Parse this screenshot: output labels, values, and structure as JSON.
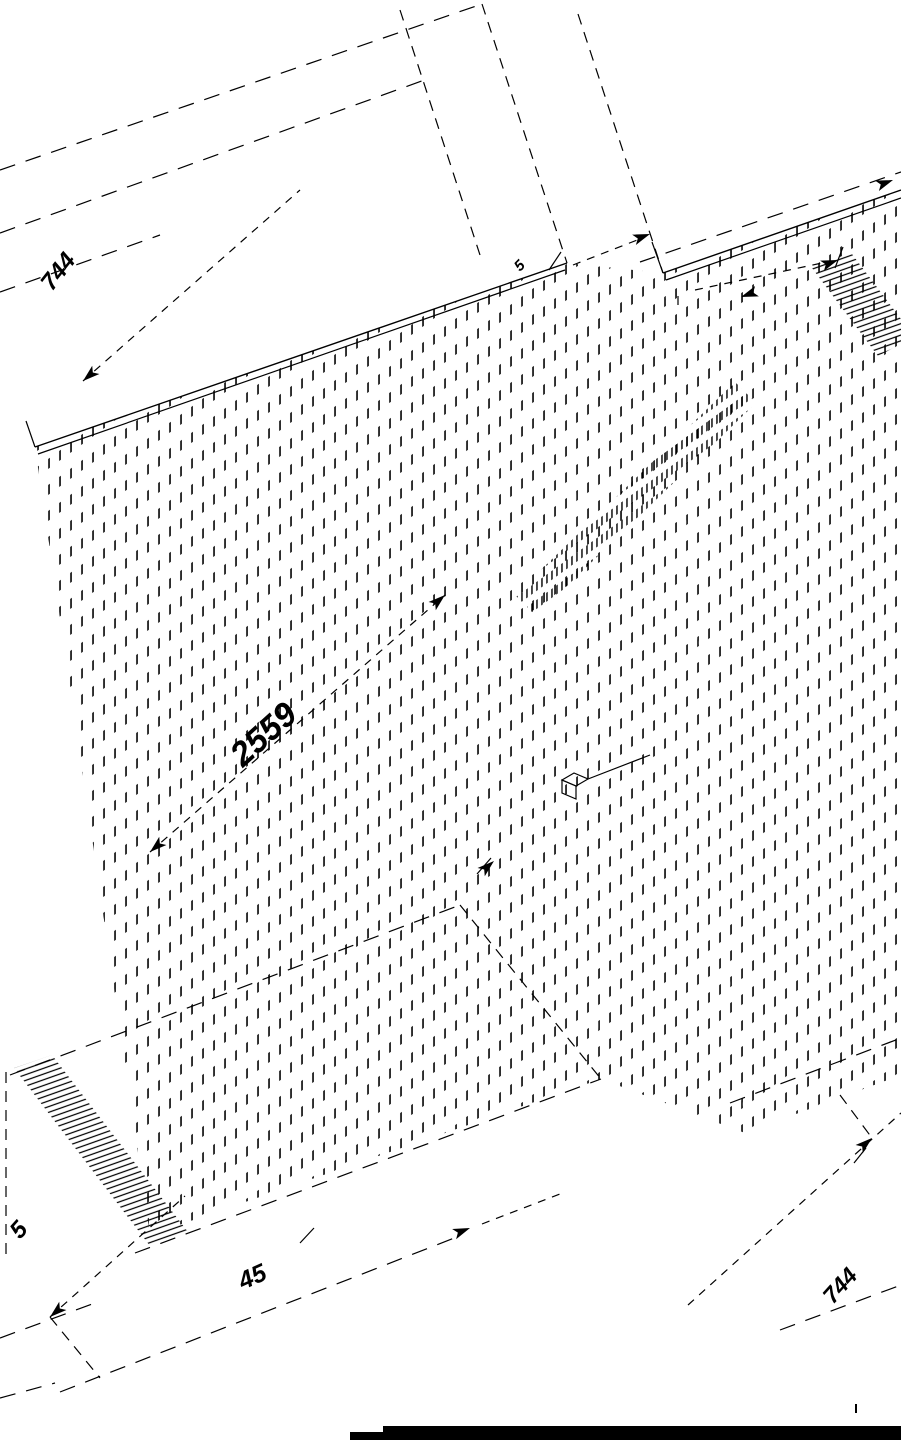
{
  "drawing": {
    "type": "isometric-panel-technical-drawing",
    "background_color": "#ffffff",
    "line_color": "#000000",
    "panels": [
      {
        "name": "left-panel",
        "hatched": true
      },
      {
        "name": "right-panel",
        "hatched": true
      }
    ],
    "dimensions": {
      "top_left_width": "744",
      "panel_height": "2559",
      "bottom_left_thickness": "5",
      "bottom_center_width": "45",
      "bottom_right_width": "744",
      "edge_gap": "5"
    },
    "footer_bar": {
      "color": "#000000"
    }
  }
}
